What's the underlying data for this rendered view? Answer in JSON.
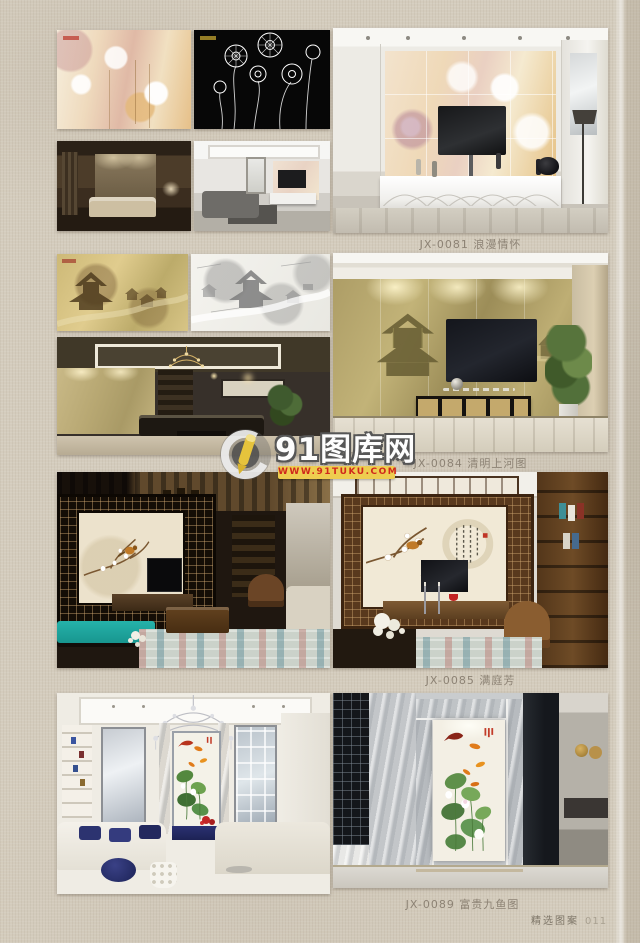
{
  "page": {
    "background_color": "#d4ccbd",
    "footer": {
      "label": "精选图案",
      "page_number": "011"
    }
  },
  "watermark": {
    "site_name": "91图库网",
    "site_url": "WWW.91TUKU.COM",
    "bar_color": "#eecd4f",
    "url_text_color": "#d0281c",
    "logo": "pencil-in-circle-logo"
  },
  "sections": [
    {
      "code": "JX-0081",
      "title": "浪漫情怀",
      "caption": "JX-0081 浪漫情怀"
    },
    {
      "code": "JX-0084",
      "title": "清明上河图",
      "caption": "JX-0084 清明上河图"
    },
    {
      "code": "JX-0085",
      "title": "满庭芳",
      "caption": "JX-0085 满庭芳"
    },
    {
      "code": "JX-0089",
      "title": "富贵九鱼图",
      "caption": "JX-0089 富贵九鱼图"
    }
  ],
  "colors": {
    "caption_text": "#8d8375",
    "teal_bench": "#1fa7a0",
    "navy_accent": "#2c3370"
  }
}
